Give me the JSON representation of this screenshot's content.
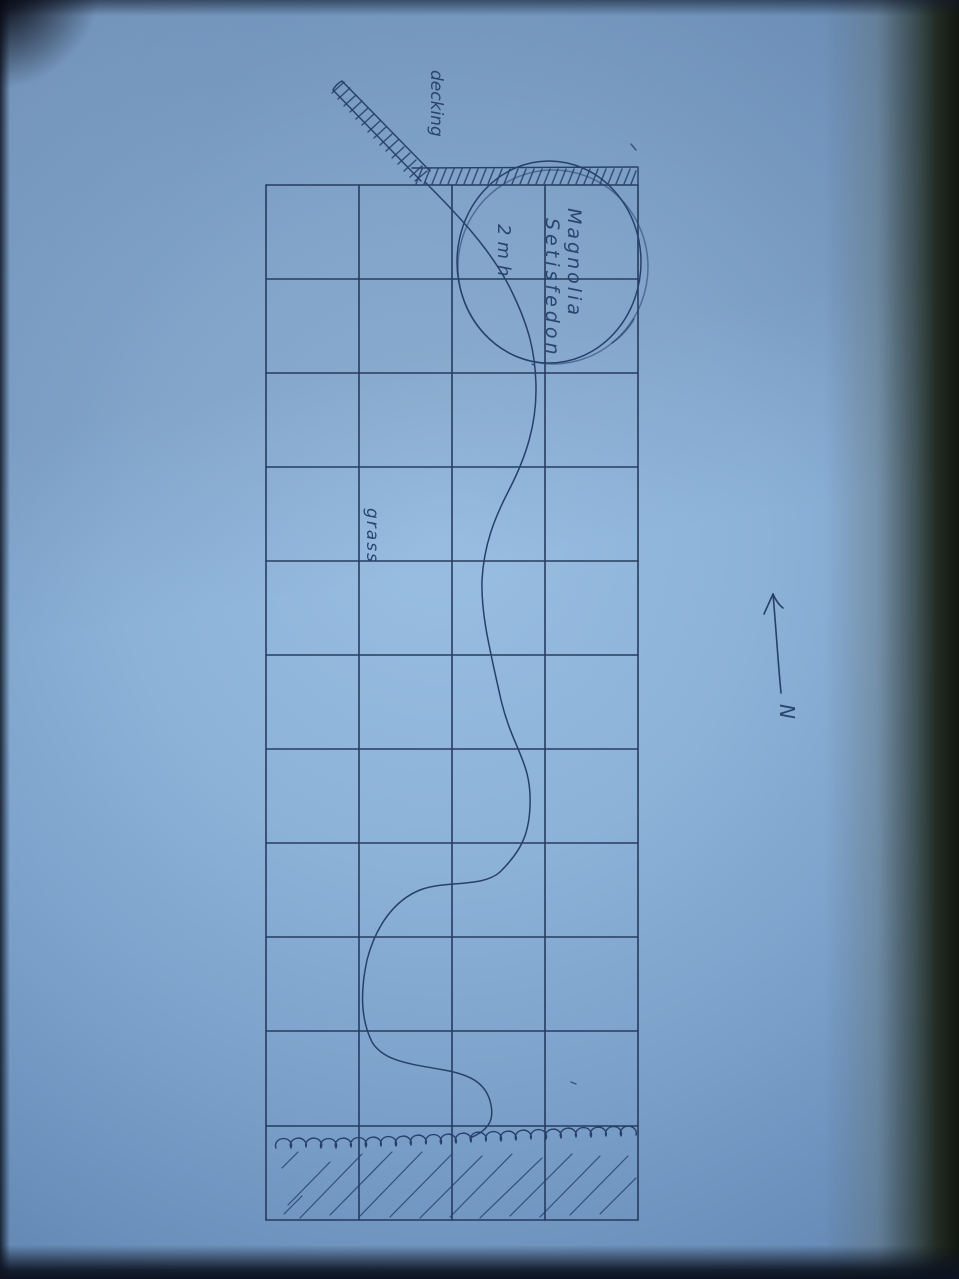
{
  "labels": {
    "decking": "decking",
    "plant_name_line1": "Magnolia",
    "plant_name_line2": "Setisfedon",
    "plant_height": "2mh",
    "grass": "grass",
    "north": "N"
  },
  "grid": {
    "columns": 4,
    "rows": 11
  },
  "colors": {
    "paper_blue": "#8fb4da",
    "grid_ink": "#22365a",
    "pen_ink": "#27406a",
    "shadow_edge": "#11160f"
  }
}
